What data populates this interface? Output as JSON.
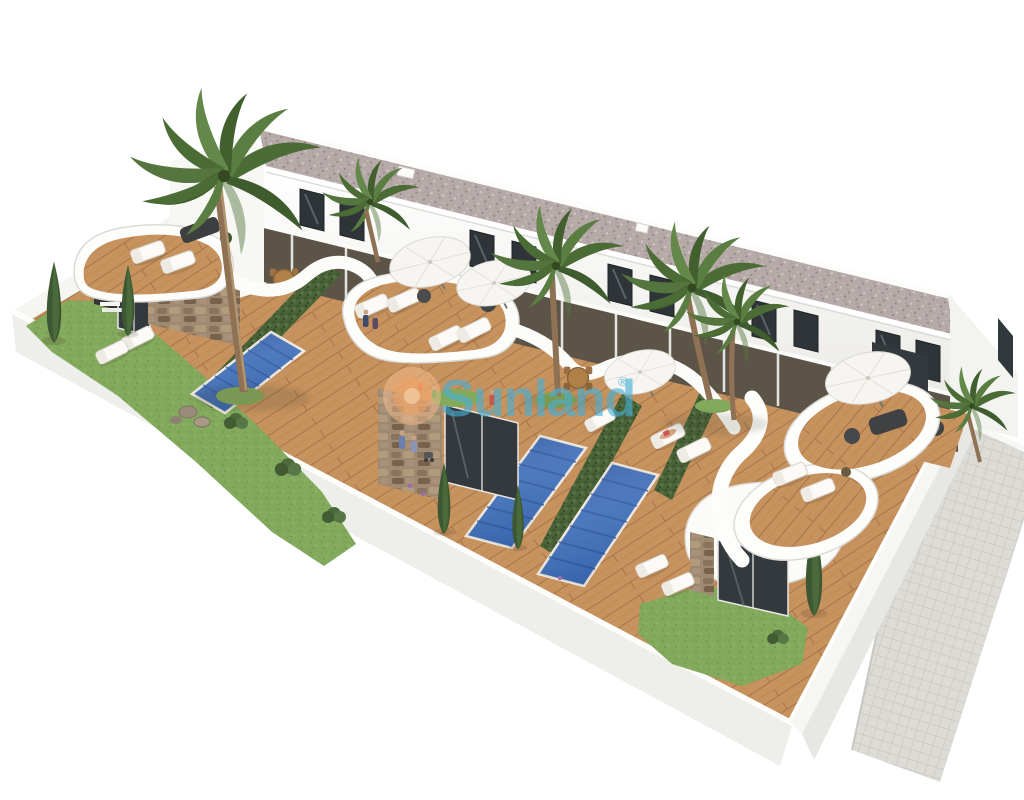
{
  "figure": {
    "alt": "Aerial 3D architectural rendering of a modern white townhouse development with curved terraces, private swimming pools, wooden sun decks, palm trees and a perimeter wall",
    "background": "#ffffff"
  },
  "watermark": {
    "text": "Sunland",
    "registered_mark": "®",
    "text_color": "#47afd7",
    "sun_outer_color": "#f4bd8e",
    "sun_mid_color": "#eda163",
    "sun_core_color": "#f7d7ae"
  },
  "palette": {
    "building_white": "#f7f6f3",
    "roof_gravel": "#b6aaa9",
    "deck_wood": "#c6925e",
    "pool_blue": "#3d6db8",
    "pool_stripe": "#2b519b",
    "hedge_green": "#4a6238",
    "grass_green": "#83a95c",
    "stone_brown": "#9f8a71",
    "walkway_tile": "#dddbd6",
    "furniture_dark": "#46484a",
    "parasol_white": "#f6f5f1"
  }
}
